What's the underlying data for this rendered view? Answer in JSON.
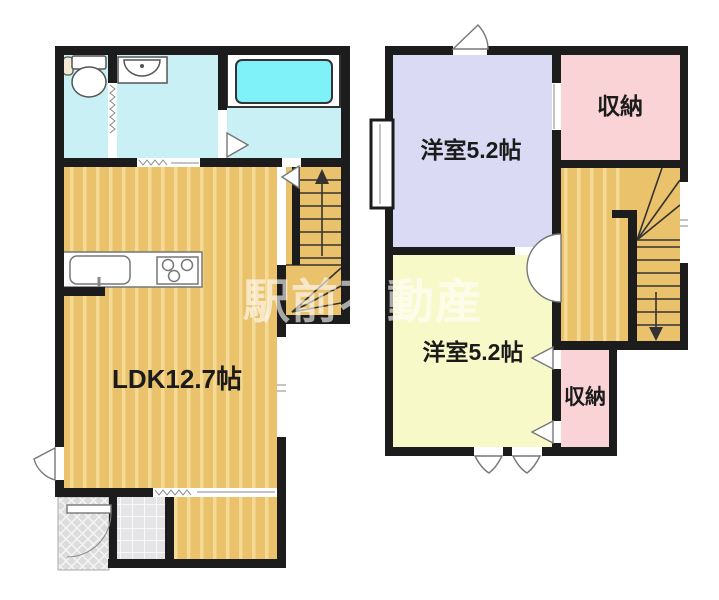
{
  "watermark": "駅前不動産",
  "colors": {
    "wall": "#1c1c1c",
    "wood_base": "#eac26c",
    "wood_stripe": "#f4da95",
    "wet_room": "#c9f0f5",
    "bathtub": "#7ef2f8",
    "bedroom_lavender": "#dadaf4",
    "bedroom_yellow": "#f8f9c8",
    "closet_pink": "#f9d3d5",
    "entry_tile": "#e5e5e8",
    "porch": "#dcdcdc"
  },
  "floor1": {
    "labels": {
      "ldk": "LDK12.7帖"
    }
  },
  "floor2": {
    "labels": {
      "bedroom_top": "洋室5.2帖",
      "closet_top": "収納",
      "bedroom_bottom": "洋室5.2帖",
      "closet_bottom": "収納"
    }
  }
}
